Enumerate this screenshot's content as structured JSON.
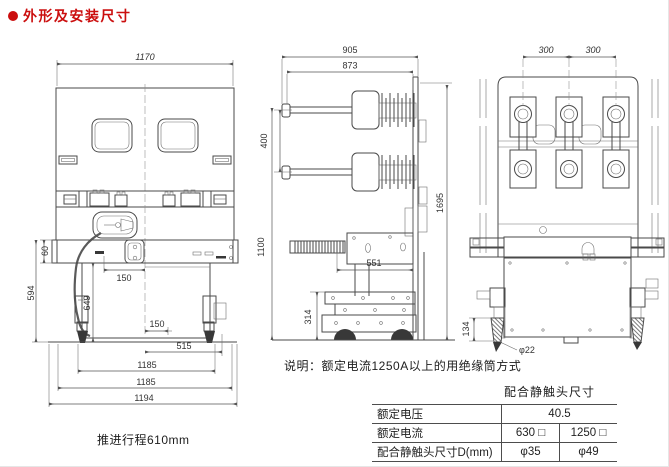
{
  "header": {
    "title": "外形及安装尺寸",
    "accent_color": "#cb0e0e"
  },
  "front_view": {
    "dim_top_width": "1170",
    "dim_beam_height": "60",
    "dim_left_height": "594",
    "dim_inner_height": "649",
    "dim_center_offset": "150",
    "dim_hole_offset": "150",
    "dim_hole_span": "515",
    "dim_wheel_span": "882",
    "dim_mount_span": "1185",
    "dim_total_width": "1194",
    "caption": "推进行程610mm"
  },
  "side_view": {
    "dim_total_depth": "905",
    "dim_body_depth": "873",
    "dim_pole_gap": "400",
    "dim_frame_height": "1100",
    "dim_total_height": "1695",
    "dim_base_depth": "551",
    "dim_chassis_height": "314"
  },
  "rear_view": {
    "dim_pitch_left": "300",
    "dim_pitch_right": "300",
    "dim_wheel_height": "134",
    "dim_wheel_dia": "φ22"
  },
  "note": "说明：额定电流1250A以上的用绝缘筒方式",
  "contact_table": {
    "title": "配合静触头尺寸",
    "rows": [
      {
        "label": "额定电压",
        "value": "40.5"
      },
      {
        "label": "额定电流",
        "v1": "630 □",
        "v2": "1250 □"
      },
      {
        "label": "配合静触头尺寸D(mm)",
        "v1": "φ35",
        "v2": "φ49"
      }
    ]
  }
}
